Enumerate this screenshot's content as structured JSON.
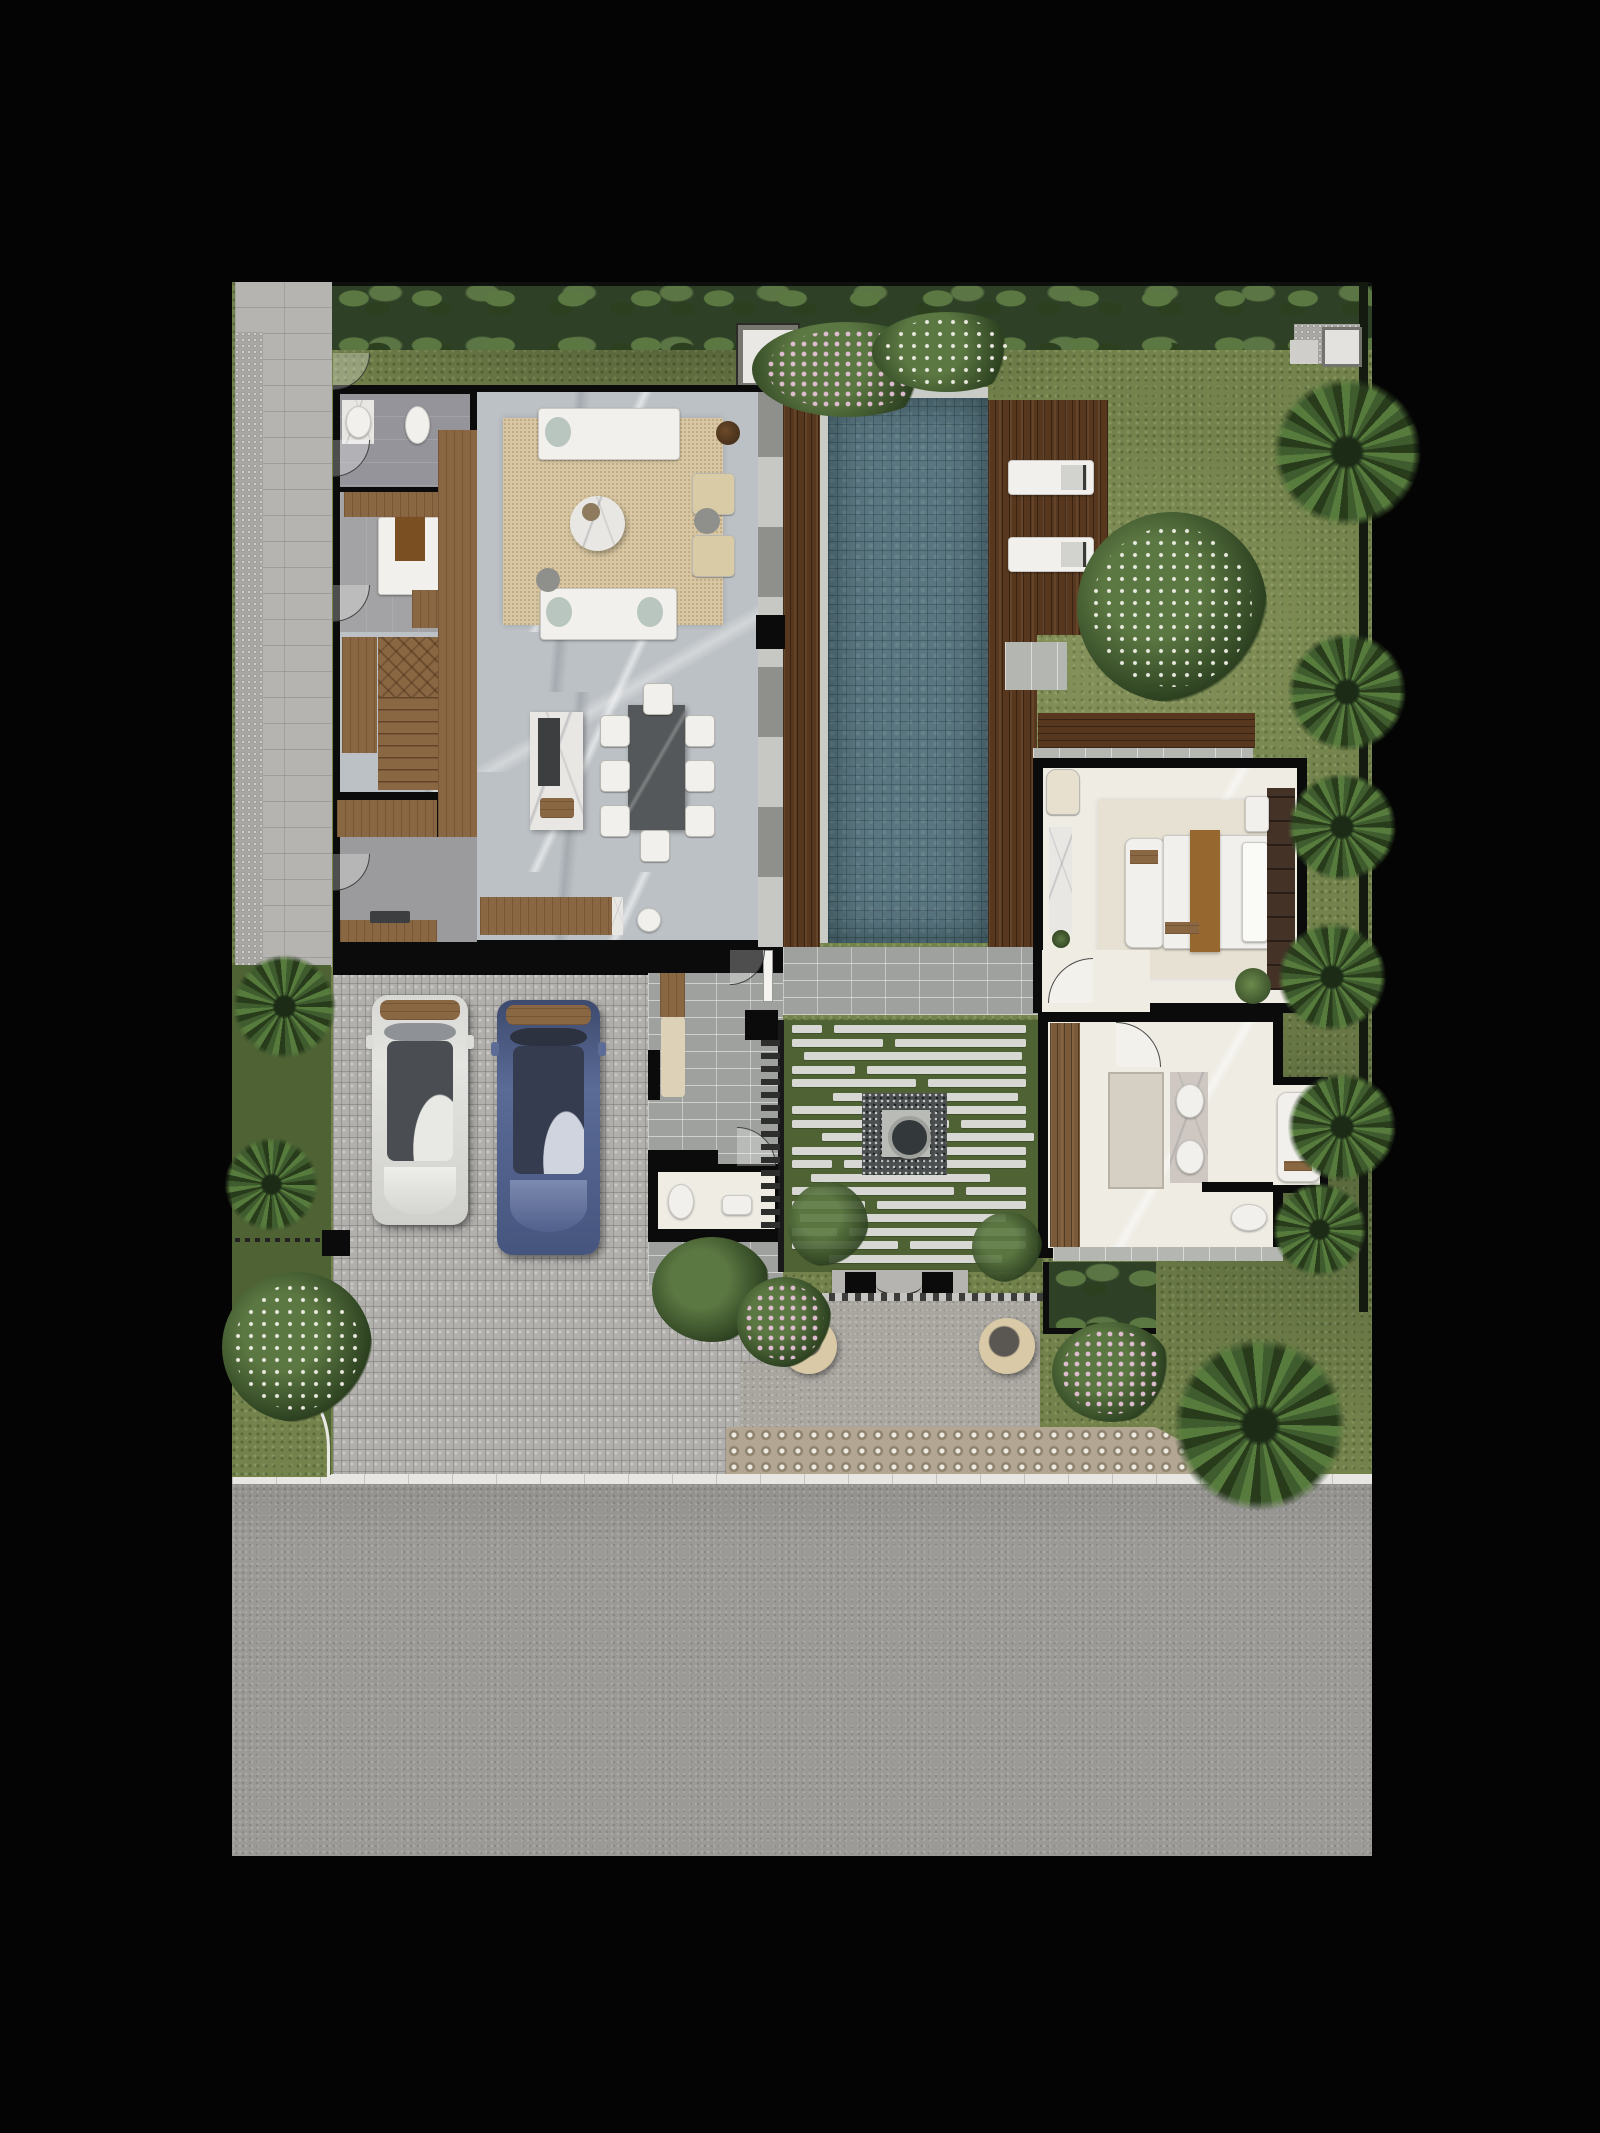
{
  "scene": {
    "kind": "architectural site plan render",
    "view": "top-down",
    "description": "Tropical villa ground-floor plan: living/dining/kitchen wing, lap pool with timber sun deck, central courtyard with fire-pit, gated entry plaza, two-car cobblestone forecourt, master bedroom and bathroom pavilion, perimeter gardens and street at bottom"
  },
  "palette": {
    "bg": "#040404",
    "wall": "#0b0b0b",
    "grass": "#74834c",
    "grass-dark": "#4e6234",
    "hedge": "#2e4126",
    "foliage": "#5c7842",
    "foliage-dark": "#2c4020",
    "palm-a": "#3f5c2f",
    "palm-b": "#283c1c",
    "palm-c": "#567b3c",
    "flower-white": "#f3f2ea",
    "flower-pink": "#e6c2d8",
    "water": "#5a7680",
    "wood-dark": "#57381f",
    "wood-mid": "#8a6743",
    "stone-floor": "#bcc1c5",
    "cream-floor": "#efece4",
    "rug": "#d8c7a2",
    "rug-bed": "#e7e1d3",
    "white-furn": "#f1f0ec",
    "marble": "#e9e7e4",
    "cobble": "#b2b0ad",
    "road": "#9c9a97",
    "curb": "#e7e6e3",
    "plaza": "#a9a6a0",
    "breeze": "#b3a794",
    "paver": "#9ea19e",
    "tile-walk": "#b6b4b1",
    "stripe": "#d7d8d3",
    "dark-counter": "#3c3e40",
    "brown-runner": "#96682f",
    "closet": "#443227",
    "car-white": "#e4e4e1",
    "car-blue": "#5a6b96",
    "fire-pit": "#33383a"
  },
  "inventory": {
    "cars": 2,
    "sun_loungers": 2,
    "dining_chairs": 8,
    "sofas": 2,
    "lounge_armchairs": 2,
    "beds": 2,
    "toilets": 3,
    "wash_basins": 5,
    "bathtubs": 1,
    "pools": 1,
    "fire_pits": 1,
    "entry_urns": 2,
    "gate_posts": 2,
    "outdoor_shower_pads": 1
  },
  "generated": {
    "dining_chairs": [
      [
        368,
        433
      ],
      [
        368,
        478
      ],
      [
        368,
        523
      ],
      [
        453,
        433
      ],
      [
        453,
        478
      ],
      [
        453,
        523
      ],
      [
        411,
        401
      ],
      [
        408,
        548
      ]
    ],
    "chair_size": [
      28,
      30
    ],
    "sun_loungers": [
      [
        776,
        178
      ],
      [
        776,
        255
      ]
    ],
    "lounger_size": [
      84,
      33
    ],
    "courtyard": {
      "x": 556,
      "y": 743,
      "w": 250,
      "h": 242,
      "rows": 18,
      "row_step": 13.5,
      "bar_h": 8
    },
    "louver": {
      "x": 529,
      "y": 758,
      "count": 15,
      "step": 13,
      "w": 19,
      "h": 6
    }
  }
}
